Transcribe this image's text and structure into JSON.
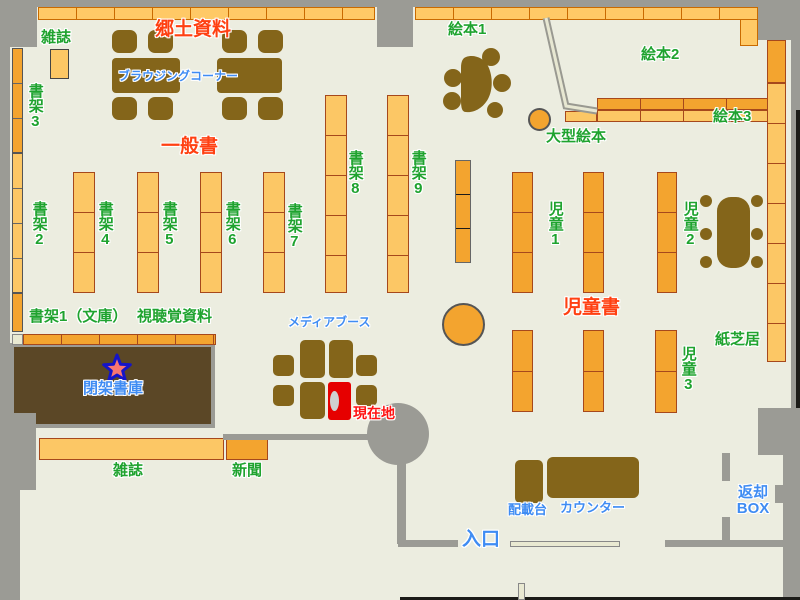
{
  "labels": {
    "zasshi_top": "雑誌",
    "shoka3": "書架3",
    "kyodo": "郷土資料",
    "browsing": "ブラウジングコーナー",
    "ippansho": "一般書",
    "shoka2": "書架2",
    "shoka4": "書架4",
    "shoka5": "書架5",
    "shoka6": "書架6",
    "shoka7": "書架7",
    "shoka8": "書架8",
    "shoka9": "書架9",
    "ehon1": "絵本1",
    "ehon2": "絵本2",
    "ehon3": "絵本3",
    "ogata_ehon": "大型絵本",
    "jido1": "児童1",
    "jido2": "児童2",
    "jido3": "児童3",
    "jidosho": "児童書",
    "kamishibai": "紙芝居",
    "shoka1_bunko": "書架1（文庫）",
    "shichokaku": "視聴覚資料",
    "media_booth": "メディアブース",
    "heika_shoko": "閉架書庫",
    "genzaichi": "現在地",
    "zasshi_bottom": "雑誌",
    "shimbun": "新聞",
    "haisaidai": "配載台",
    "counter": "カウンター",
    "iriguchi": "入口",
    "henkyaku_line1": "返却",
    "henkyaku_line2": "BOX"
  },
  "colors": {
    "floor": "#ECEDE0",
    "wall_gray": "#9B9B95",
    "wood_brown": "#84651A",
    "closed_stacks_brown": "#5B4726",
    "shelf_light_orange": "#FCC765",
    "shelf_dark_orange": "#F3A42F",
    "shelf_border": "#A6481C",
    "label_green": "#1FA32F",
    "label_red_orange": "#FF4012",
    "label_blue": "#3F8CF3",
    "current_location_red": "#E60000",
    "star_fill": "#F87671",
    "star_border": "#1414C8"
  }
}
